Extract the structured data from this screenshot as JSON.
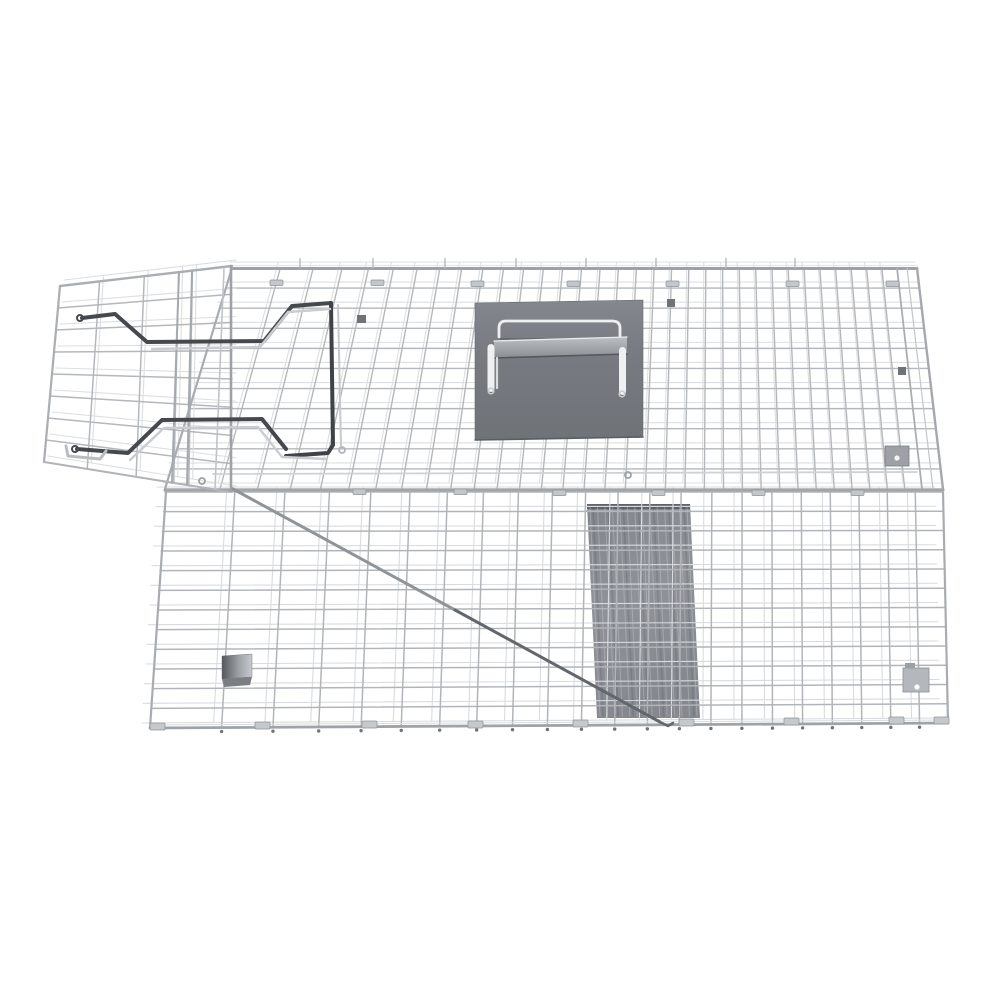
{
  "meta": {
    "alt": "Silver galvanized wire mesh live-capture animal trap cage with open entry door, dark steel door-lock rods, a sheet-metal carry handle cover plate on top, an internal gray trip ramp, a long diagonal trigger rod and latch plates, photographed on a plain white background",
    "background": "#ffffff",
    "canvas": {
      "w": 1000,
      "h": 1000
    }
  },
  "product": {
    "name": "wire-mesh live animal trap cage",
    "finish": "galvanized silver",
    "parts": [
      {
        "name": "roof-mesh"
      },
      {
        "name": "front-mesh"
      },
      {
        "name": "open-door-mesh"
      },
      {
        "name": "door-lock-rods"
      },
      {
        "name": "carry-handle-plate"
      },
      {
        "name": "carry-handle-bail"
      },
      {
        "name": "internal-trip-ramp"
      },
      {
        "name": "trigger-rod"
      },
      {
        "name": "bait-pedal-block"
      },
      {
        "name": "latch-plate-upper"
      },
      {
        "name": "latch-plate-lower"
      },
      {
        "name": "base-feet-clips"
      }
    ]
  },
  "palette": {
    "wire": "#b4b7bb",
    "wire_light": "#dcdee1",
    "wire_dark": "#8f9398",
    "rail": "#a2a6ab",
    "dark_rod": "#44474b",
    "plate": "#7b7f85",
    "ramp": "#888c92",
    "white_metal": "#eef0f2",
    "background": "#ffffff"
  },
  "drawing": {
    "gradients": [
      {
        "id": "gradPlate",
        "x1": 0,
        "y1": 0,
        "x2": 0,
        "y2": 1,
        "stops": [
          [
            0,
            "#84888e"
          ],
          [
            0.35,
            "#787c82"
          ],
          [
            1,
            "#6f7378"
          ]
        ]
      },
      {
        "id": "gradGrip",
        "x1": 0,
        "y1": 0,
        "x2": 0,
        "y2": 1,
        "stops": [
          [
            0,
            "#bcbfc3"
          ],
          [
            1,
            "#8a8e93"
          ]
        ]
      },
      {
        "id": "gradRamp",
        "x1": 0,
        "y1": 0,
        "x2": 0.25,
        "y2": 1,
        "stops": [
          [
            0,
            "#82868c"
          ],
          [
            0.5,
            "#8f9399"
          ],
          [
            1,
            "#85898f"
          ]
        ]
      },
      {
        "id": "gradBlock",
        "x1": 0,
        "y1": 0,
        "x2": 1,
        "y2": 0,
        "stops": [
          [
            0,
            "#54585c"
          ],
          [
            0.55,
            "#9da1a6"
          ],
          [
            1,
            "#c6c9cd"
          ]
        ]
      }
    ],
    "ops": [
      {
        "t": "poly",
        "name": "internal-trip-ramp",
        "pts": [
          [
            587,
            504
          ],
          [
            690,
            504
          ],
          [
            700,
            718
          ],
          [
            597,
            718
          ]
        ],
        "fill": "url(#gradRamp)"
      },
      {
        "t": "poly",
        "name": "ramp-top-bar",
        "pts": [
          [
            587,
            504
          ],
          [
            690,
            504
          ],
          [
            690,
            509
          ],
          [
            587,
            509
          ]
        ],
        "fill": "#60646a"
      },
      {
        "t": "line",
        "x1": 587,
        "y1": 511,
        "x2": 690,
        "y2": 511,
        "stroke": "#9da1a6",
        "lw": 2
      },
      {
        "t": "streaks",
        "tl": [
          590,
          507
        ],
        "tr": [
          687,
          507
        ],
        "bl": [
          600,
          716
        ],
        "br": [
          697,
          716
        ],
        "n": 14,
        "stroke": "rgba(255,255,255,0.22)",
        "lw": 1
      },
      {
        "t": "streaks",
        "tl": [
          593,
          507
        ],
        "tr": [
          684,
          507
        ],
        "bl": [
          603,
          716
        ],
        "br": [
          694,
          716
        ],
        "n": 7,
        "stroke": "rgba(40,44,48,0.14)",
        "lw": 1.6
      },
      {
        "t": "grid",
        "name": "front-mesh",
        "tl": [
          165,
          492
        ],
        "tr": [
          943,
          492
        ],
        "br": [
          948,
          723
        ],
        "bl": [
          150,
          728
        ],
        "rows": 12,
        "cols": 22,
        "colPow": 0.78,
        "stroke": "#b1b5b9",
        "lw": 1.5,
        "echo": {
          "dx": -8,
          "dy": -5,
          "stroke": "#d9dbde",
          "lw": 1.1
        },
        "dots": {
          "dy": 4,
          "r": 1.7,
          "color": "#70747a"
        }
      },
      {
        "t": "grid",
        "name": "roof-mesh",
        "tl": [
          232,
          268
        ],
        "tr": [
          917,
          268
        ],
        "br": [
          943,
          489
        ],
        "bl": [
          165,
          489
        ],
        "colTR": [
          897,
          268
        ],
        "colBR": [
          922,
          489
        ],
        "rows": 11,
        "cols": 33,
        "colPow": 0.75,
        "stroke": "#b4b7bb",
        "lw": 1.4,
        "echo": {
          "dx": -2,
          "dy": -6,
          "stroke": "#dddfe1",
          "lw": 1.1
        }
      },
      {
        "t": "grid",
        "name": "door-mesh",
        "tl": [
          60,
          286
        ],
        "tr": [
          232,
          266
        ],
        "br": [
          232,
          492
        ],
        "bl": [
          44,
          462
        ],
        "rows": 8,
        "colsU": [
          0.23,
          0.49,
          0.69,
          0.77
        ],
        "stroke": "#b4b7bb",
        "lw": 1.5,
        "echo": {
          "dx": 4,
          "dy": -6,
          "stroke": "#dcdee0",
          "lw": 1.1
        }
      },
      {
        "t": "line",
        "x1": 232,
        "y1": 265.5,
        "x2": 917,
        "y2": 265.5,
        "stroke": "#e4e6e8",
        "lw": 1.2
      },
      {
        "t": "line",
        "x1": 232,
        "y1": 268.5,
        "x2": 917,
        "y2": 268.5,
        "stroke": "#9ea2a7",
        "lw": 3
      },
      {
        "t": "line",
        "x1": 232,
        "y1": 268,
        "x2": 165,
        "y2": 489,
        "stroke": "#a9adb2",
        "lw": 2.2
      },
      {
        "t": "line",
        "x1": 897,
        "y1": 268,
        "x2": 922,
        "y2": 489,
        "stroke": "#aaadb2",
        "lw": 1.8
      },
      {
        "t": "line",
        "x1": 907,
        "y1": 268,
        "x2": 933,
        "y2": 489,
        "stroke": "#c2c5c9",
        "lw": 1.2
      },
      {
        "t": "line",
        "x1": 917,
        "y1": 268,
        "x2": 943,
        "y2": 489,
        "stroke": "#a5a9ae",
        "lw": 2.4
      },
      {
        "t": "line",
        "x1": 213,
        "y1": 474,
        "x2": 917,
        "y2": 472,
        "stroke": "#cfd2d5",
        "lw": 1.8
      },
      {
        "t": "line",
        "x1": 165,
        "y1": 490,
        "x2": 943,
        "y2": 490,
        "stroke": "#a2a6ab",
        "lw": 3
      },
      {
        "t": "line",
        "x1": 166,
        "y1": 492,
        "x2": 150,
        "y2": 728,
        "stroke": "#a8acb1",
        "lw": 2.2
      },
      {
        "t": "line",
        "x1": 943,
        "y1": 492,
        "x2": 948,
        "y2": 723,
        "stroke": "#a8acb1",
        "lw": 2.2
      },
      {
        "t": "line",
        "x1": 150,
        "y1": 728,
        "x2": 948,
        "y2": 723,
        "stroke": "#9fa3a8",
        "lw": 2.8
      },
      {
        "t": "line",
        "x1": 150,
        "y1": 725,
        "x2": 948,
        "y2": 720,
        "stroke": "#d8dadd",
        "lw": 1
      },
      {
        "t": "line",
        "x1": 60,
        "y1": 286,
        "x2": 232,
        "y2": 266,
        "stroke": "#aaaeb3",
        "lw": 2.4
      },
      {
        "t": "line",
        "x1": 60,
        "y1": 286,
        "x2": 44,
        "y2": 462,
        "stroke": "#aaaeb3",
        "lw": 2.2
      },
      {
        "t": "line",
        "x1": 44,
        "y1": 462,
        "x2": 230,
        "y2": 492,
        "stroke": "#b0b4b8",
        "lw": 2
      },
      {
        "t": "line",
        "x1": 231,
        "y1": 266,
        "x2": 231,
        "y2": 491,
        "stroke": "#9ea2a7",
        "lw": 2.6
      },
      {
        "t": "line",
        "x1": 224,
        "y1": 269,
        "x2": 215,
        "y2": 489,
        "stroke": "#c0c3c7",
        "lw": 1.6
      },
      {
        "t": "line",
        "x1": 179,
        "y1": 272,
        "x2": 172,
        "y2": 483,
        "stroke": "#a6aaaf",
        "lw": 2
      },
      {
        "t": "line",
        "x1": 192,
        "y1": 271,
        "x2": 187,
        "y2": 485,
        "stroke": "#a6aaaf",
        "lw": 2
      },
      {
        "t": "line",
        "x1": 338,
        "y1": 305,
        "x2": 341,
        "y2": 447,
        "stroke": "#c6c9cd",
        "lw": 2
      },
      {
        "t": "stubs",
        "xs": [
          300,
          373,
          445,
          516,
          586,
          656,
          726,
          795
        ],
        "y1": 268,
        "y2": 258.5,
        "stroke": "#b0b4b8",
        "lw": 1.3
      },
      {
        "t": "poly",
        "name": "carry-handle-plate",
        "pts": [
          [
            475,
            303
          ],
          [
            643,
            300
          ],
          [
            643,
            437
          ],
          [
            475,
            440
          ]
        ],
        "fill": "url(#gradPlate)",
        "stroke": "#686c71",
        "lw": 0.6
      },
      {
        "t": "path",
        "name": "carry-handle-bail",
        "d": "M499,337 L499,328 Q499,321 506,321 L612,321 Q620,321 620,328 L620,338",
        "stroke": "#edeff1",
        "lw": 2.8
      },
      {
        "t": "line",
        "x1": 500,
        "y1": 339,
        "x2": 619,
        "y2": 339,
        "stroke": "#5d6165",
        "lw": 1.2
      },
      {
        "t": "poly",
        "name": "handle-grip-bar",
        "pts": [
          [
            494,
            341
          ],
          [
            627,
            337
          ],
          [
            627,
            354
          ],
          [
            494,
            358
          ]
        ],
        "fill": "url(#gradGrip)"
      },
      {
        "t": "line",
        "x1": 494,
        "y1": 341,
        "x2": 627,
        "y2": 337,
        "stroke": "#e9ebed",
        "lw": 1.3
      },
      {
        "t": "line",
        "x1": 494,
        "y1": 358,
        "x2": 627,
        "y2": 354,
        "stroke": "#54575b",
        "lw": 1.6
      },
      {
        "t": "line",
        "x1": 497,
        "y1": 358,
        "x2": 497,
        "y2": 388,
        "stroke": "#dadcde",
        "lw": 2.2
      },
      {
        "t": "line",
        "x1": 623,
        "y1": 354,
        "x2": 623,
        "y2": 391,
        "stroke": "#dadcde",
        "lw": 2.2
      },
      {
        "t": "rect",
        "x": 487.5,
        "y": 344,
        "w": 7,
        "h": 48,
        "rx": 3.5,
        "fill": "#eef0f2"
      },
      {
        "t": "rect",
        "x": 619,
        "y": 347,
        "w": 7,
        "h": 48,
        "rx": 3.5,
        "fill": "#eef0f2"
      },
      {
        "t": "circle",
        "cx": 491,
        "cy": 391,
        "r": 2.8,
        "stroke": "#c9ccd0",
        "lw": 1.6
      },
      {
        "t": "circle",
        "cx": 622,
        "cy": 394,
        "r": 2.8,
        "stroke": "#c9ccd0",
        "lw": 1.6
      },
      {
        "t": "line",
        "x1": 475,
        "y1": 440,
        "x2": 643,
        "y2": 437,
        "stroke": "#5a5e62",
        "lw": 1.6
      },
      {
        "t": "polyline",
        "name": "door-lock-rod-upper",
        "pts": [
          [
            82,
            318
          ],
          [
            115,
            314
          ],
          [
            147,
            342
          ],
          [
            264,
            341
          ],
          [
            292,
            306
          ],
          [
            331,
            303
          ]
        ],
        "stroke": "#45484d",
        "lw": 4
      },
      {
        "t": "polyline",
        "name": "door-lock-bar",
        "pts": [
          [
            331,
            303
          ],
          [
            333,
            445
          ],
          [
            328,
            453
          ],
          [
            286,
            456
          ]
        ],
        "stroke": "#3f4347",
        "lw": 4
      },
      {
        "t": "polyline",
        "name": "door-lock-rod-lower",
        "pts": [
          [
            77,
            449
          ],
          [
            128,
            453
          ],
          [
            162,
            420
          ],
          [
            262,
            419
          ],
          [
            286,
            449
          ]
        ],
        "stroke": "#45484d",
        "lw": 4
      },
      {
        "t": "polyline",
        "pts": [
          [
            152,
            349
          ],
          [
            260,
            347
          ],
          [
            288,
            312
          ],
          [
            330,
            309
          ]
        ],
        "stroke": "#c9ccd0",
        "lw": 2.4
      },
      {
        "t": "polyline",
        "pts": [
          [
            130,
            460
          ],
          [
            164,
            428
          ],
          [
            258,
            427
          ],
          [
            282,
            457
          ],
          [
            326,
            459
          ]
        ],
        "stroke": "#c9ccd0",
        "lw": 2.4
      },
      {
        "t": "polyline",
        "name": "door-frame-corner",
        "pts": [
          [
            66,
            446
          ],
          [
            68,
            456
          ],
          [
            100,
            459
          ],
          [
            106,
            451
          ]
        ],
        "stroke": "#b9bcc0",
        "lw": 3
      },
      {
        "t": "polyline",
        "name": "trigger-rod",
        "pts": [
          [
            233,
            489
          ],
          [
            455,
            610
          ]
        ],
        "stroke": "#8f9499",
        "lw": 3
      },
      {
        "t": "polyline",
        "pts": [
          [
            455,
            610
          ],
          [
            660,
            722
          ]
        ],
        "stroke": "#63676c",
        "lw": 3
      },
      {
        "t": "polyline",
        "pts": [
          [
            660,
            722
          ],
          [
            668,
            726
          ],
          [
            673,
            723
          ]
        ],
        "stroke": "#63676c",
        "lw": 2.5
      },
      {
        "t": "poly",
        "name": "bait-pedal-block",
        "pts": [
          [
            222,
            656
          ],
          [
            252,
            654
          ],
          [
            252,
            677
          ],
          [
            222,
            679
          ]
        ],
        "fill": "url(#gradBlock)",
        "stroke": "#5f6367",
        "lw": 0.4
      },
      {
        "t": "poly",
        "pts": [
          [
            222,
            679
          ],
          [
            252,
            677
          ],
          [
            250,
            685
          ],
          [
            224,
            687
          ]
        ],
        "fill": "#7b7f84"
      },
      {
        "t": "rect",
        "name": "latch-plate-upper",
        "x": 885,
        "y": 446,
        "w": 24,
        "h": 20,
        "fill": "#9da1a6",
        "stroke": "#7b7f84",
        "lw": 0.8
      },
      {
        "t": "circle",
        "cx": 897,
        "cy": 458,
        "r": 2.6,
        "fill": "#f3f4f5"
      },
      {
        "t": "rect",
        "name": "latch-plate-lower",
        "x": 903,
        "y": 668,
        "w": 26,
        "h": 24,
        "fill": "#b4b7bb",
        "stroke": "#8b8f94",
        "lw": 0.8
      },
      {
        "t": "circle",
        "cx": 917,
        "cy": 687,
        "r": 2.6,
        "fill": "#ffffff"
      },
      {
        "t": "rect",
        "x": 905,
        "y": 663,
        "w": 10,
        "h": 5,
        "fill": "#9da1a6"
      },
      {
        "t": "rect",
        "x": 357,
        "y": 315,
        "w": 9,
        "h": 8,
        "fill": "#6f7378"
      },
      {
        "t": "rect",
        "x": 667,
        "y": 299,
        "w": 8,
        "h": 8,
        "fill": "#6f7378"
      },
      {
        "t": "rect",
        "x": 898,
        "y": 367,
        "w": 8,
        "h": 8,
        "fill": "#6f7378"
      },
      {
        "t": "tabs",
        "w": 13,
        "h": 5.5,
        "fill": "#c3c6ca",
        "stroke": "#8f9398",
        "pts": [
          [
            270,
            280
          ],
          [
            371,
            280
          ],
          [
            471,
            281
          ],
          [
            567,
            281
          ],
          [
            666,
            281
          ],
          [
            786,
            281
          ],
          [
            886,
            281
          ],
          [
            353,
            489
          ],
          [
            454,
            489
          ],
          [
            553,
            490
          ],
          [
            652,
            490
          ],
          [
            752,
            490
          ],
          [
            851,
            490
          ]
        ]
      },
      {
        "t": "tabs",
        "w": 15,
        "h": 7,
        "fill": "#c6c9cc",
        "stroke": "#8e9297",
        "pts": [
          [
            150,
            723
          ],
          [
            255,
            722
          ],
          [
            362,
            721
          ],
          [
            468,
            721
          ],
          [
            573,
            720
          ],
          [
            679,
            719
          ],
          [
            784,
            718
          ],
          [
            889,
            717
          ],
          [
            934,
            717
          ]
        ]
      },
      {
        "t": "circle",
        "cx": 202,
        "cy": 481,
        "r": 3,
        "stroke": "#9aa0a5",
        "lw": 1.8
      },
      {
        "t": "circle",
        "cx": 628,
        "cy": 475,
        "r": 3,
        "stroke": "#9aa0a5",
        "lw": 1.8
      },
      {
        "t": "circle",
        "cx": 80,
        "cy": 318,
        "r": 3,
        "stroke": "#45484d",
        "lw": 2
      },
      {
        "t": "circle",
        "cx": 75,
        "cy": 449,
        "r": 3,
        "stroke": "#45484d",
        "lw": 2
      },
      {
        "t": "circle",
        "cx": 342,
        "cy": 450,
        "r": 3,
        "stroke": "#b0b4b8",
        "lw": 1.8
      }
    ]
  }
}
